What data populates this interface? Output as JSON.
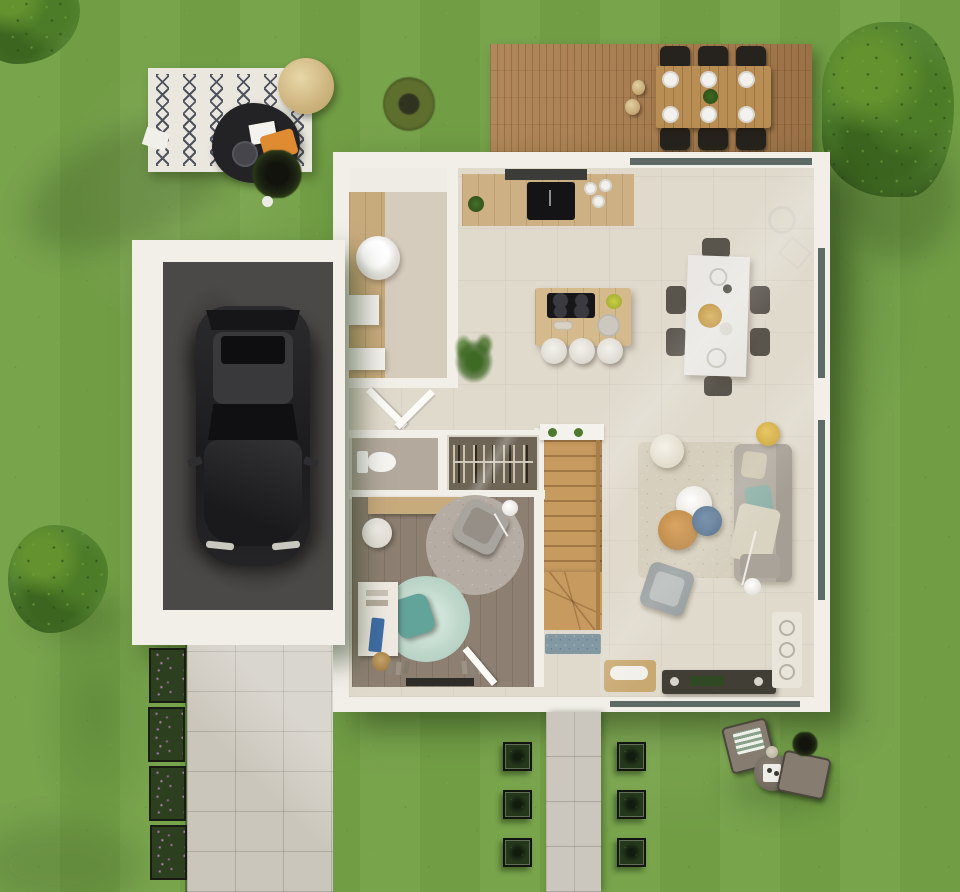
{
  "meta": {
    "description": "Top-down 3D architectural render of a single-storey house with garden, wooden deck, garage with car, driveway and patio",
    "visible_text": "none"
  },
  "colors": {
    "grass": "#74a147",
    "tree_dark": "#33551f",
    "bush_green": "#4d7c2b",
    "ornamental_grass": "#5d6e2d",
    "rug_outdoor": "#eae7df",
    "rug_pattern_navy": "#343a4a",
    "coffee_table_black": "#232325",
    "pouf_beige": "#d9c48f",
    "throw_orange": "#df8b31",
    "deck_wood": "#a87c4d",
    "outdoor_table_wood": "#b98e55",
    "outdoor_chair_dark": "#26231e",
    "plate_white": "#f2f1ed",
    "house_wall_white": "#f2efe9",
    "floor_cream_tile": "#e0dacd",
    "floor_pantry": "#d6ccbd",
    "wood_light": "#c8ab7d",
    "kitchen_counter_wood": "#cdb184",
    "island_wood": "#d4ba8c",
    "cooktop_black": "#17171a",
    "sink_black": "#141416",
    "hood_dark": "#3c3d39",
    "dining_table_white": "#e9e8e4",
    "dining_chair_gray": "#59544c",
    "living_rug_cream": "#d6cfbe",
    "sofa_gray": "#b2aca2",
    "sofa_back_gray": "#a49e94",
    "cushion_teal": "#8fb2a9",
    "cushion_beige": "#cfc7b2",
    "blanket_cream": "#d9d3c2",
    "side_table_oak": "#c68e4c",
    "side_table_blue": "#5c7894",
    "side_table_yellow": "#d9b23e",
    "armchair_gray": "#9aa0a1",
    "tv_console_dark": "#413e36",
    "bench_wood": "#c9a972",
    "shelf_light": "#e9e5db",
    "stairs_wood": "#c79a5f",
    "doormat_blue": "#8299a4",
    "closet_interior": "#6e6557",
    "wc_floor": "#b3a99d",
    "toilet_white": "#f6f5f2",
    "bedroom_wood_floor": "#8d8072",
    "bedroom_rug_gray": "#b5ada3",
    "bedroom_rug_mint": "#bed7ca",
    "lounge_chair_teal": "#62a39a",
    "lounge_chair_gray": "#a8a49e",
    "desk_white": "#eeeae2",
    "yoga_mat_blue": "#3f6da6",
    "basket_tan": "#b08d55",
    "threshold_dark": "#2e2c28",
    "window_glass": "#5d6a66",
    "garage_floor_concrete": "#4b4947",
    "car_body": "#232325",
    "car_roof": "#39393b",
    "car_glass": "#101013",
    "driveway_pavers": "#cbc6bc",
    "walkway_pavers": "#cbc7be",
    "flower_planter_green": "#2c3f1e",
    "flower_pink": "#c77fc0",
    "shrub_green": "#24381b",
    "patio_chair_taupe": "#867d70",
    "patio_table_taupe": "#7b7268",
    "tray_white": "#efede7",
    "washer_white": "#f4f3ef",
    "stool_white": "#e9e7e1"
  },
  "scene": {
    "garden": {
      "trees": [
        "corner-foliage-top-left",
        "large-tree-top-right",
        "bush-left-edge",
        "ornamental-grass-shrub"
      ],
      "outdoor_lounge": {
        "rug": "white rug with navy zigzag pattern",
        "items": [
          "black coffee table with tray",
          "beige pouf",
          "orange throw",
          "black potted plant",
          "white paper"
        ]
      }
    },
    "deck": {
      "material": "wood planks",
      "dining_set": {
        "table": "wood",
        "chairs": 6,
        "plates": 6,
        "centerpiece": "green plant",
        "jugs": 2
      }
    },
    "house": {
      "rooms": [
        "pantry-laundry",
        "kitchen",
        "dining-area",
        "living-room",
        "hallway",
        "wc",
        "coat-closet",
        "staircase",
        "bedroom-office"
      ],
      "kitchen": {
        "island_stools": 3,
        "cooktop_burners": 4
      },
      "dining": {
        "chairs": 6
      },
      "living": {
        "sofa": 1,
        "coffee_tables": 3,
        "poufs": 1,
        "armchair": 1,
        "floor_lamp": 1
      }
    },
    "garage": {
      "car": "dark SUV, top view",
      "floor": "concrete"
    },
    "landscaping": {
      "flower_planters": 4,
      "shrub_planters": 6
    },
    "patio_set": {
      "lounge_chairs": 2,
      "round_table": 1,
      "plant": 1
    }
  }
}
